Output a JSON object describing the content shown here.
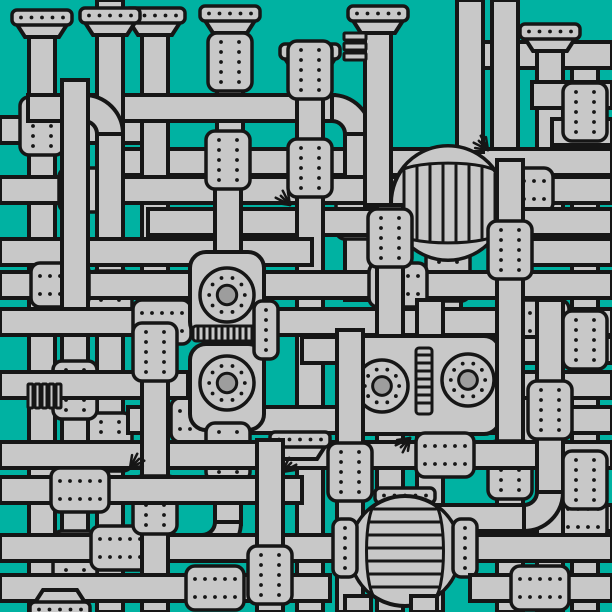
{
  "meta": {
    "label": "Dense illustrated maze of interconnected gray industrial pipes with riveted couplings, end caps, two striped tanks, gauge dials and vent sprays on a teal background",
    "width": 612,
    "height": 612
  },
  "palette": {
    "background": "#00B2A2",
    "pipe": "#C8C8C8",
    "outline": "#161616",
    "gauge_inner": "#9D9D9D"
  },
  "geometry": {
    "pipe_thickness": 26,
    "pipe_stroke": 4,
    "detail_stroke": 3,
    "rivet_radius": 1.9,
    "tank_stripe_step": 13,
    "vent_ray_length": 13,
    "vent_ray_count": 5
  },
  "scene": {
    "elements": [
      {
        "t": "h",
        "y": 130,
        "x1": 0,
        "x2": 148
      },
      {
        "t": "v",
        "x": 42,
        "y1": 20,
        "y2": 612
      },
      {
        "t": "cap",
        "x": 42,
        "y": 10,
        "d": "up"
      },
      {
        "t": "flgv",
        "x": 42,
        "y": 126
      },
      {
        "t": "v",
        "x": 585,
        "y1": 48,
        "y2": 612
      },
      {
        "t": "h",
        "y": 55,
        "x1": 468,
        "x2": 612
      },
      {
        "t": "v",
        "x": 550,
        "y1": 34,
        "y2": 240
      },
      {
        "t": "cap",
        "x": 550,
        "y": 24,
        "d": "up"
      },
      {
        "t": "h",
        "y": 95,
        "x1": 532,
        "x2": 612
      },
      {
        "t": "h",
        "y": 132,
        "x1": 552,
        "x2": 612
      },
      {
        "t": "v",
        "x": 505,
        "y1": 0,
        "y2": 162
      },
      {
        "t": "h",
        "y": 162,
        "x1": 118,
        "x2": 612
      },
      {
        "t": "v",
        "x": 155,
        "y1": 12,
        "y2": 335
      },
      {
        "t": "cap",
        "x": 155,
        "y": 8,
        "d": "up"
      },
      {
        "t": "v",
        "x": 230,
        "y1": 14,
        "y2": 150
      },
      {
        "t": "cap",
        "x": 230,
        "y": 6,
        "d": "up"
      },
      {
        "t": "flgv",
        "x": 230,
        "y": 62
      },
      {
        "t": "h",
        "y": 108,
        "x1": 28,
        "x2": 334
      },
      {
        "t": "v",
        "x": 358,
        "y1": 134,
        "y2": 300
      },
      {
        "t": "elbow",
        "x": 332,
        "y": 134,
        "r": 26,
        "o": "tr"
      },
      {
        "t": "flgv",
        "x": 358,
        "y": 210
      },
      {
        "t": "h",
        "y": 190,
        "x1": 0,
        "x2": 612
      },
      {
        "t": "flgh",
        "x": 88,
        "y": 190
      },
      {
        "t": "flgh",
        "x": 524,
        "y": 190
      },
      {
        "t": "v",
        "x": 110,
        "y1": 0,
        "y2": 612
      },
      {
        "t": "cap",
        "x": 110,
        "y": 8,
        "d": "up"
      },
      {
        "t": "elbow",
        "x": 84,
        "y": 134,
        "r": 26,
        "o": "tr"
      },
      {
        "t": "flgv",
        "x": 110,
        "y": 300
      },
      {
        "t": "flgv",
        "x": 110,
        "y": 442
      },
      {
        "t": "h",
        "y": 222,
        "x1": 148,
        "x2": 612
      },
      {
        "t": "v",
        "x": 310,
        "y1": 52,
        "y2": 612
      },
      {
        "t": "cap",
        "x": 310,
        "y": 44,
        "d": "up"
      },
      {
        "t": "flgv",
        "x": 310,
        "y": 70
      },
      {
        "t": "flgv",
        "x": 310,
        "y": 168
      },
      {
        "t": "h",
        "y": 252,
        "x1": 0,
        "x2": 312
      },
      {
        "t": "h",
        "y": 252,
        "x1": 520,
        "x2": 612
      },
      {
        "t": "v",
        "x": 378,
        "y1": 10,
        "y2": 205
      },
      {
        "t": "cap",
        "x": 378,
        "y": 6,
        "d": "up"
      },
      {
        "t": "fins",
        "x": 344,
        "y": 33,
        "w": 22,
        "h": 22,
        "o": "h"
      },
      {
        "t": "v",
        "x": 470,
        "y1": 0,
        "y2": 152
      },
      {
        "t": "v",
        "x": 448,
        "y1": 255,
        "y2": 350
      },
      {
        "t": "flgv",
        "x": 448,
        "y": 272
      },
      {
        "t": "tank",
        "cx": 448,
        "cy": 203,
        "r": 57,
        "o": "v"
      },
      {
        "t": "vent",
        "x": 488,
        "y": 150,
        "d": "nw"
      },
      {
        "t": "h",
        "y": 285,
        "x1": 0,
        "x2": 612
      },
      {
        "t": "flgh",
        "x": 60,
        "y": 285
      },
      {
        "t": "flgh",
        "x": 398,
        "y": 285
      },
      {
        "t": "v",
        "x": 75,
        "y1": 80,
        "y2": 612
      },
      {
        "t": "flgv",
        "x": 75,
        "y": 390
      },
      {
        "t": "flgv",
        "x": 75,
        "y": 560
      },
      {
        "t": "h",
        "y": 322,
        "x1": 0,
        "x2": 612
      },
      {
        "t": "flgh",
        "x": 162,
        "y": 322
      },
      {
        "t": "flgh",
        "x": 540,
        "y": 322
      },
      {
        "t": "v",
        "x": 390,
        "y1": 205,
        "y2": 612
      },
      {
        "t": "flgv",
        "x": 390,
        "y": 238
      },
      {
        "t": "v",
        "x": 430,
        "y1": 300,
        "y2": 612
      },
      {
        "t": "h",
        "y": 350,
        "x1": 302,
        "x2": 612
      },
      {
        "t": "h",
        "y": 420,
        "x1": 128,
        "x2": 612
      },
      {
        "t": "flgh",
        "x": 200,
        "y": 420
      },
      {
        "t": "flgh",
        "x": 530,
        "y": 420
      },
      {
        "t": "body",
        "x": 348,
        "y": 336,
        "w": 152,
        "h": 98
      },
      {
        "t": "ladder",
        "x": 416,
        "y": 348,
        "w": 16,
        "h": 66
      },
      {
        "t": "gauge",
        "cx": 382,
        "cy": 386,
        "r": 26
      },
      {
        "t": "gauge",
        "cx": 468,
        "cy": 380,
        "r": 26
      },
      {
        "t": "v",
        "x": 228,
        "y1": 136,
        "y2": 270
      },
      {
        "t": "flgv",
        "x": 228,
        "y": 160
      },
      {
        "t": "body",
        "x": 190,
        "y": 252,
        "w": 74,
        "h": 86
      },
      {
        "t": "body",
        "x": 190,
        "y": 344,
        "w": 74,
        "h": 86
      },
      {
        "t": "band",
        "x": 193,
        "y": 326,
        "w": 68,
        "h": 15
      },
      {
        "t": "flgs",
        "x": 266,
        "y": 330
      },
      {
        "t": "gauge",
        "cx": 227,
        "cy": 295,
        "r": 27
      },
      {
        "t": "gauge",
        "cx": 227,
        "cy": 383,
        "r": 27
      },
      {
        "t": "v",
        "x": 228,
        "y1": 428,
        "y2": 524
      },
      {
        "t": "flgv",
        "x": 228,
        "y": 452
      },
      {
        "t": "elbow",
        "x": 202,
        "y": 522,
        "r": 26,
        "o": "br"
      },
      {
        "t": "h",
        "y": 548,
        "x1": 0,
        "x2": 352
      },
      {
        "t": "flgh",
        "x": 120,
        "y": 548
      },
      {
        "t": "h",
        "y": 385,
        "x1": 0,
        "x2": 188
      },
      {
        "t": "h",
        "y": 385,
        "x1": 518,
        "x2": 612
      },
      {
        "t": "v",
        "x": 510,
        "y1": 160,
        "y2": 612
      },
      {
        "t": "flgv",
        "x": 510,
        "y": 250
      },
      {
        "t": "flgv",
        "x": 510,
        "y": 470
      },
      {
        "t": "h",
        "y": 455,
        "x1": 0,
        "x2": 612
      },
      {
        "t": "flgh",
        "x": 445,
        "y": 455
      },
      {
        "t": "vent",
        "x": 410,
        "y": 438,
        "d": "sw"
      },
      {
        "t": "v",
        "x": 350,
        "y1": 330,
        "y2": 612
      },
      {
        "t": "flgv",
        "x": 350,
        "y": 472
      },
      {
        "t": "cap",
        "x": 300,
        "y": 432,
        "d": "up"
      },
      {
        "t": "vent",
        "x": 282,
        "y": 472,
        "d": "ne"
      },
      {
        "t": "v",
        "x": 155,
        "y1": 330,
        "y2": 612
      },
      {
        "t": "flgv",
        "x": 155,
        "y": 352
      },
      {
        "t": "flgv",
        "x": 155,
        "y": 505
      },
      {
        "t": "h",
        "y": 490,
        "x1": 0,
        "x2": 302
      },
      {
        "t": "flgh",
        "x": 80,
        "y": 490
      },
      {
        "t": "h",
        "y": 518,
        "x1": 428,
        "x2": 612
      },
      {
        "t": "flgh",
        "x": 578,
        "y": 518
      },
      {
        "t": "v",
        "x": 550,
        "y1": 300,
        "y2": 612
      },
      {
        "t": "flgv",
        "x": 550,
        "y": 410
      },
      {
        "t": "elbow",
        "x": 524,
        "y": 492,
        "r": 26,
        "o": "br"
      },
      {
        "t": "flgv",
        "x": 585,
        "y": 112
      },
      {
        "t": "flgv",
        "x": 585,
        "y": 340
      },
      {
        "t": "flgv",
        "x": 585,
        "y": 480
      },
      {
        "t": "cap",
        "x": 405,
        "y": 488,
        "d": "up"
      },
      {
        "t": "tank",
        "cx": 405,
        "cy": 551,
        "r": 55,
        "o": "h"
      },
      {
        "t": "h",
        "y": 548,
        "x1": 458,
        "x2": 612
      },
      {
        "t": "flgs",
        "x": 345,
        "y": 548
      },
      {
        "t": "flgs",
        "x": 465,
        "y": 548
      },
      {
        "t": "v",
        "x": 358,
        "y1": 596,
        "y2": 612
      },
      {
        "t": "v",
        "x": 424,
        "y1": 596,
        "y2": 612
      },
      {
        "t": "h",
        "y": 588,
        "x1": 0,
        "x2": 330
      },
      {
        "t": "flgh",
        "x": 215,
        "y": 588
      },
      {
        "t": "h",
        "y": 588,
        "x1": 470,
        "x2": 612
      },
      {
        "t": "flgh",
        "x": 540,
        "y": 588
      },
      {
        "t": "v",
        "x": 270,
        "y1": 440,
        "y2": 612
      },
      {
        "t": "flgv",
        "x": 270,
        "y": 575
      },
      {
        "t": "cap",
        "x": 60,
        "y": 602,
        "d": "down"
      },
      {
        "t": "fins",
        "x": 28,
        "y": 384,
        "w": 34,
        "h": 24,
        "o": "v"
      },
      {
        "t": "vent",
        "x": 130,
        "y": 468,
        "d": "ne"
      },
      {
        "t": "vent",
        "x": 290,
        "y": 205,
        "d": "nw"
      }
    ]
  }
}
